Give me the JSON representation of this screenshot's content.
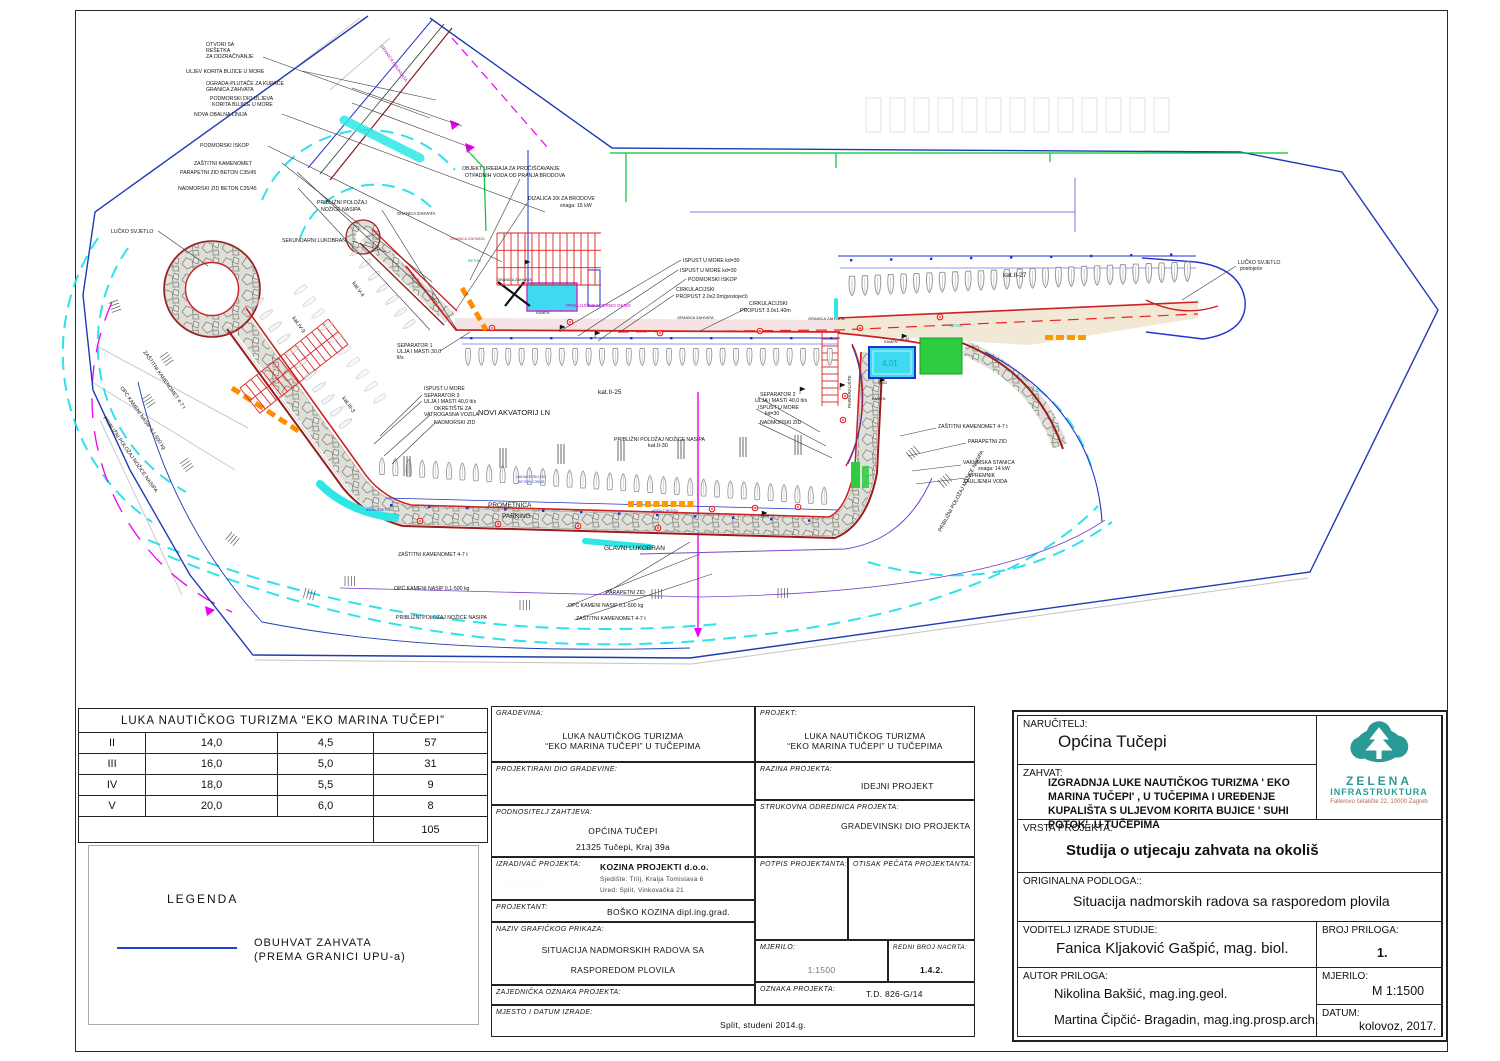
{
  "vessel_table": {
    "title": "LUKA NAUTIČKOG TURIZMA “EKO MARINA TUČEPI”",
    "rows": [
      [
        "II",
        "14,0",
        "4,5",
        "57"
      ],
      [
        "III",
        "16,0",
        "5,0",
        "31"
      ],
      [
        "IV",
        "18,0",
        "5,5",
        "9"
      ],
      [
        "V",
        "20,0",
        "6,0",
        "8"
      ]
    ],
    "total": "105"
  },
  "legend": {
    "title": "LEGENDA",
    "line1": "OBUHVAT ZAHVATA",
    "line2": "(PREMA GRANICI UPU-a)"
  },
  "cad_block": {
    "gradevina_label": "GRADEVINA:",
    "gradevina_1": "LUKA NAUTIČKOG TURIZMA",
    "gradevina_2": "“EKO MARINA TUČEPI” U TUČEPIMA",
    "projektirani_label": "PROJEKTIRANI DIO GRADEVINE:",
    "podnositelj_label": "PODNOSITELJ ZAHTJEVA:",
    "podnositelj_1": "OPĆINA TUČEPI",
    "podnositelj_2": "21325 Tučepi, Kraj 39a",
    "izradivac_label": "IZRADIVAČ PROJEKTA:",
    "izradivac_1": "KOZINA PROJEKTI d.o.o.",
    "izradivac_2": "Sjedište: Trilj, Kralja Tomislava 6",
    "izradivac_3": "Ured: Split, Vinkovačka 21",
    "projektant_label": "PROJEKTANT:",
    "projektant_value": "BOŠKO KOZINA dipl.ing.grad.",
    "naziv_label": "NAZIV GRAFIČKOG PRIKAZA:",
    "naziv_1": "SITUACIJA  NADMORSKIH RADOVA SA",
    "naziv_2": "RASPOREDOM PLOVILA",
    "zajednicka_label": "ZAJEDNIČKA OZNAKA PROJEKTA:",
    "mjesto_label": "MJESTO I DATUM IZRADE:",
    "mjesto_value": "Split, studeni 2014.g.",
    "projekt_label": "PROJEKT:",
    "projekt_1": "LUKA NAUTIČKOG TURIZMA",
    "projekt_2": "“EKO MARINA TUČEPI” U TUČEPIMA",
    "razina_label": "RAZINA PROJEKTA:",
    "razina_value": "IDEJNI PROJEKT",
    "strukovna_label": "STRUKOVNA ODREDNICA PROJEKTA:",
    "strukovna_value": "GRADEVINSKI DIO PROJEKTA",
    "potpis_label": "POTPIS PROJEKTANTA:",
    "otisak_label": "OTISAK PEČATA PROJEKTANTA:",
    "mjerilo_label": "MJERILO:",
    "mjerilo_value": "1:1500",
    "redni_label": "REDNI BROJ NACRTA:",
    "redni_value": "1.4.2.",
    "oznaka_label": "OZNAKA PROJEKTA:",
    "oznaka_value": "T.D. 826-G/14"
  },
  "study_block": {
    "narucitelj_label": "NARUČITELJ:",
    "narucitelj_value": "Općina Tučepi",
    "zahvat_label": "ZAHVAT:",
    "zahvat_value": "IZGRADNJA LUKE NAUTIČKOG TURIZMA ' EKO MARINA TUČEPI' , U TUČEPIMA I UREĐENJE KUPALIŠTA S ULJEVOM KORITA BUJICE ' SUHI POTOK', U TUČEPIMA",
    "vrsta_label": "VRSTA PROJEKTA:",
    "vrsta_value": "Studija o utjecaju zahvata na okoliš",
    "podloga_label": "ORIGINALNA PODLOGA::",
    "podloga_value": "Situacija nadmorskih radova sa rasporedom plovila",
    "voditelj_label": "VODITELJ IZRADE STUDIJE:",
    "voditelj_value": "Fanica Kljaković Gašpić, mag. biol.",
    "broj_label": "BROJ PRILOGA:",
    "broj_value": "1.",
    "autor_label": "AUTOR PRILOGA:",
    "autor_1": "Nikolina Bakšić, mag.ing.geol.",
    "autor_2": "Martina Čipčić- Bragadin, mag.ing.prosp.arch.",
    "mjerilo_label": "MJERILO:",
    "mjerilo_value": "M 1:1500",
    "datum_label": "DATUM:",
    "datum_value": "kolovoz, 2017.",
    "logo_name1": "ZELENA",
    "logo_name2": "INFRASTRUKTURA",
    "logo_address": "Fallerovo šetalište 22, 10000 Zagreb",
    "logo_color": "#2a9a96"
  },
  "drawing": {
    "labels": [
      {
        "t": "OTVORI SA",
        "x": 206,
        "y": 46
      },
      {
        "t": "REŠETKA",
        "x": 206,
        "y": 52
      },
      {
        "t": "ZA ODZRAČIVANJE",
        "x": 206,
        "y": 58
      },
      {
        "t": "ULJEV KORITA BUJICE U MORE",
        "x": 186,
        "y": 73
      },
      {
        "t": "OGRADA-PLUTAČE ZA KUPAČE",
        "x": 206,
        "y": 85
      },
      {
        "t": "GRANICA ZAHVATA",
        "x": 206,
        "y": 91
      },
      {
        "t": "PODMORSKI DIO ULJEVA",
        "x": 210,
        "y": 100
      },
      {
        "t": "KORITA BUJICE U MORE",
        "x": 212,
        "y": 106
      },
      {
        "t": "NOVA OBALNA LINIJA",
        "x": 194,
        "y": 116
      },
      {
        "t": "PODMORSKI ISKOP",
        "x": 200,
        "y": 147
      },
      {
        "t": "ZAŠTITNI KAMENOMET",
        "x": 194,
        "y": 165
      },
      {
        "t": "PARAPETNI ZID BETON C35/45",
        "x": 180,
        "y": 174
      },
      {
        "t": "NADMORSKI ZID BETON C35/45",
        "x": 178,
        "y": 190
      },
      {
        "t": "PRIBLIŽNI POLOŽAJ",
        "x": 317,
        "y": 204
      },
      {
        "t": "NOŽICE NASIPA",
        "x": 321,
        "y": 211
      },
      {
        "t": "LUČKO SVJETLO",
        "x": 111,
        "y": 233
      },
      {
        "t": "SEKUNDARNI LUKOBRAN",
        "x": 282,
        "y": 242
      },
      {
        "t": "GRANICA ZAHVATA",
        "x": 397,
        "y": 215,
        "s": 4.2
      },
      {
        "t": "OBJEKT UREĐAJA ZA PROČIŠĆAVANJE",
        "x": 462,
        "y": 170
      },
      {
        "t": "OTPADNIH VODA OD PRANJA BRODOVA",
        "x": 465,
        "y": 177
      },
      {
        "t": "DIZALICA 20t ZA BRODOVE",
        "x": 528,
        "y": 200
      },
      {
        "t": "snaga: 15 kW",
        "x": 560,
        "y": 207
      },
      {
        "t": "ISPUST U MORE kd=30",
        "x": 683,
        "y": 262
      },
      {
        "t": "ISPUST U MORE kd=30",
        "x": 680,
        "y": 272
      },
      {
        "t": "PODMORSKI ISKOP",
        "x": 688,
        "y": 281
      },
      {
        "t": "CIRKULACIJSKI",
        "x": 676,
        "y": 291
      },
      {
        "t": "PROPUST 2.0x2.0m(postojeći)",
        "x": 676,
        "y": 298
      },
      {
        "t": "CIRKULACIJSKI",
        "x": 749,
        "y": 305
      },
      {
        "t": "PROPUST 3.0x1.40m",
        "x": 740,
        "y": 312
      },
      {
        "t": "GRANICA ZAHVATA",
        "x": 677,
        "y": 319,
        "s": 4
      },
      {
        "t": "GRANICA ZAHVATA",
        "x": 808,
        "y": 320,
        "s": 4
      },
      {
        "t": "PRIKLJUČNO MJERNO OKNO",
        "x": 566,
        "y": 307,
        "s": 4.6,
        "c": "#cc00cc"
      },
      {
        "t": "SEPARATOR 1",
        "x": 397,
        "y": 347
      },
      {
        "t": "ULJA I MASTI 30,0",
        "x": 397,
        "y": 353
      },
      {
        "t": "lt/s",
        "x": 397,
        "y": 359
      },
      {
        "t": "kat.II-25",
        "x": 598,
        "y": 394,
        "s": 6.5
      },
      {
        "t": "ISPUST U MORE",
        "x": 424,
        "y": 390
      },
      {
        "t": "SEPARATOR 3",
        "x": 424,
        "y": 397
      },
      {
        "t": "ULJA I MASTI 40,0 lt/s",
        "x": 424,
        "y": 403
      },
      {
        "t": "OKRETIŠTE ZA",
        "x": 434,
        "y": 410
      },
      {
        "t": "VATROGASNA VOZILA",
        "x": 424,
        "y": 416
      },
      {
        "t": "NOVI AKVATORIJ LN",
        "x": 478,
        "y": 415,
        "s": 7.5
      },
      {
        "t": "NADMORSKI ZID",
        "x": 434,
        "y": 424
      },
      {
        "t": "SEPARATOR 2",
        "x": 760,
        "y": 396
      },
      {
        "t": "ULJA I MASTI 40,0 lt/s",
        "x": 755,
        "y": 402
      },
      {
        "t": "ISPUST U MORE",
        "x": 758,
        "y": 409
      },
      {
        "t": "kd=30",
        "x": 765,
        "y": 415
      },
      {
        "t": "NADMORSKI ZID",
        "x": 760,
        "y": 424
      },
      {
        "t": "PRIBLIŽNI POLOŽAJ NOŽICE NASIPA",
        "x": 614,
        "y": 441
      },
      {
        "t": "kat.II-30",
        "x": 648,
        "y": 447,
        "s": 5.5
      },
      {
        "t": "PROMETNICA",
        "x": 488,
        "y": 507,
        "s": 6.5
      },
      {
        "t": "PARKING",
        "x": 502,
        "y": 518,
        "s": 6.5
      },
      {
        "t": "ZAŠTITNI KAMENOMET 4-7 t",
        "x": 398,
        "y": 556
      },
      {
        "t": "GLAVNI LUKOBRAN",
        "x": 604,
        "y": 550,
        "s": 6.5
      },
      {
        "t": "OPĆ KAMENI NASIP 0,1-500 kg",
        "x": 394,
        "y": 590
      },
      {
        "t": "PARAPETNI ZID",
        "x": 606,
        "y": 594
      },
      {
        "t": "OPĆ KAMENI NASIP 0,1-500 kg",
        "x": 568,
        "y": 607
      },
      {
        "t": "ZAŠTITNI KAMENOMET 4-7 t",
        "x": 576,
        "y": 620
      },
      {
        "t": "PRIBLIŽNI POLOŽAJ NOŽICE NASIPA",
        "x": 396,
        "y": 619
      },
      {
        "t": "kat.II-27",
        "x": 1003,
        "y": 277,
        "s": 6.5
      },
      {
        "t": "LUČKO SVJETLO",
        "x": 1238,
        "y": 264
      },
      {
        "t": "postojeće",
        "x": 1240,
        "y": 270
      },
      {
        "t": "ZAŠTITNI KAMENOMET 4-7 t",
        "x": 938,
        "y": 428
      },
      {
        "t": "PARAPETNI ZID",
        "x": 968,
        "y": 443
      },
      {
        "t": "VAKUMSKA STANICA",
        "x": 963,
        "y": 464
      },
      {
        "t": "snaga: 14 kW",
        "x": 978,
        "y": 470
      },
      {
        "t": "SPREMNIK",
        "x": 968,
        "y": 477
      },
      {
        "t": "ZAULJENIH VODA",
        "x": 963,
        "y": 483
      },
      {
        "t": "ZAŠTITNI KAMENOMET 4-7 t",
        "x": 143,
        "y": 352,
        "r": 55
      },
      {
        "t": "OPĆ KAMENI NASIP 0,1-500 kg",
        "x": 120,
        "y": 388,
        "r": 55
      },
      {
        "t": "PRIBLIŽNI POLOŽAJ NOŽICE NASIPA",
        "x": 103,
        "y": 418,
        "r": 55
      },
      {
        "t": "PRIBLIŽNI POLOŽAJ NOŽICE NASIPA",
        "x": 941,
        "y": 532,
        "r": -62
      },
      {
        "t": "kat.IV-9",
        "x": 292,
        "y": 318,
        "r": 55,
        "s": 5.5
      },
      {
        "t": "kat.III-3",
        "x": 342,
        "y": 398,
        "r": 55,
        "s": 5.5
      },
      {
        "t": "kat.V-4",
        "x": 352,
        "y": 283,
        "r": 55,
        "s": 5.5
      },
      {
        "t": "GRANICA OBUHVATA",
        "x": 380,
        "y": 46,
        "r": 55,
        "s": 4.4,
        "c": "#cc00cc"
      },
      {
        "t": "PARKIRALIŠTE",
        "x": 851,
        "y": 408,
        "r": -90,
        "s": 4.6
      },
      {
        "t": "KAMEN",
        "x": 884,
        "y": 343,
        "s": 3.8
      },
      {
        "t": "KAMEN",
        "x": 872,
        "y": 400,
        "s": 3.8
      },
      {
        "t": "KAMEN",
        "x": 536,
        "y": 314,
        "s": 3.8
      },
      {
        "t": "BETON",
        "x": 950,
        "y": 327,
        "s": 3.8,
        "c": "#00aaaa"
      },
      {
        "t": "BETON",
        "x": 468,
        "y": 262,
        "s": 3.8,
        "c": "#00aaaa"
      },
      {
        "t": "ASFALT BETON",
        "x": 366,
        "y": 511,
        "s": 3.5,
        "c": "#2233cc"
      },
      {
        "t": "ASFALT BETON",
        "x": 652,
        "y": 512,
        "s": 3.5,
        "c": "#2233cc"
      },
      {
        "t": "4.01",
        "x": 882,
        "y": 366,
        "s": 8,
        "c": "#0aa6c4"
      },
      {
        "t": "+1.44",
        "x": 900,
        "y": 340,
        "s": 3.6
      },
      {
        "t": "+1.63",
        "x": 878,
        "y": 384,
        "s": 3.6
      },
      {
        "t": "+1.28",
        "x": 760,
        "y": 517,
        "s": 3.6
      },
      {
        "t": "NADMORSKI ZID",
        "x": 516,
        "y": 478,
        "s": 3.8,
        "c": "#3344cc"
      },
      {
        "t": "BETON C35/45",
        "x": 518,
        "y": 483,
        "s": 3.8,
        "c": "#3344cc"
      },
      {
        "t": "GRANICA ZAHVATA",
        "x": 450,
        "y": 240,
        "s": 3.8,
        "c": "#cc2222"
      },
      {
        "t": "GRANICA ZAHVATA",
        "x": 497,
        "y": 281,
        "s": 3.8
      }
    ],
    "leaders": [
      [
        263,
        57,
        430,
        118
      ],
      [
        302,
        71,
        436,
        100
      ],
      [
        352,
        88,
        462,
        126
      ],
      [
        352,
        103,
        472,
        148
      ],
      [
        282,
        114,
        545,
        212
      ],
      [
        268,
        146,
        502,
        262
      ],
      [
        282,
        163,
        432,
        282
      ],
      [
        297,
        172,
        437,
        302
      ],
      [
        298,
        188,
        430,
        330
      ],
      [
        382,
        210,
        457,
        330
      ],
      [
        158,
        231,
        208,
        266
      ],
      [
        352,
        241,
        386,
        252
      ],
      [
        520,
        179,
        470,
        280
      ],
      [
        527,
        203,
        456,
        310
      ],
      [
        681,
        260,
        562,
        330
      ],
      [
        678,
        270,
        578,
        336
      ],
      [
        686,
        279,
        598,
        341
      ],
      [
        674,
        295,
        620,
        332
      ],
      [
        747,
        308,
        700,
        331
      ],
      [
        440,
        351,
        470,
        332
      ],
      [
        422,
        395,
        380,
        436
      ],
      [
        422,
        401,
        374,
        444
      ],
      [
        430,
        415,
        384,
        456
      ],
      [
        436,
        422,
        392,
        464
      ],
      [
        758,
        397,
        820,
        432
      ],
      [
        756,
        409,
        826,
        446
      ],
      [
        758,
        423,
        832,
        458
      ],
      [
        604,
        594,
        690,
        542
      ],
      [
        566,
        607,
        700,
        554
      ],
      [
        574,
        620,
        712,
        574
      ],
      [
        1236,
        266,
        1182,
        300
      ],
      [
        936,
        428,
        900,
        436
      ],
      [
        966,
        443,
        908,
        456
      ],
      [
        961,
        465,
        912,
        471
      ],
      [
        966,
        478,
        916,
        484
      ]
    ],
    "boat_rows": [
      {
        "x": 468,
        "y": 357,
        "n": 28,
        "dx": 13.4,
        "dy": 0,
        "rot": 180
      },
      {
        "x": 382,
        "y": 466,
        "n": 34,
        "dx": 13.4,
        "dy": 0.9,
        "rot": 0
      },
      {
        "x": 852,
        "y": 286,
        "n": 27,
        "dx": 12.9,
        "dy": -0.55,
        "rot": 180,
        "sc": 1.15
      },
      {
        "x": 258,
        "y": 302,
        "n": 11,
        "dx": 8.8,
        "dy": 12.1,
        "rot": 55,
        "sc": 0.85,
        "op": 0.5
      },
      {
        "x": 300,
        "y": 290,
        "n": 10,
        "dx": 8.8,
        "dy": 12.1,
        "rot": 235,
        "sc": 0.85,
        "op": 0.4
      },
      {
        "x": 356,
        "y": 252,
        "n": 7,
        "dx": 8.8,
        "dy": 12.1,
        "rot": 235,
        "sc": 0.8,
        "op": 0.5
      }
    ],
    "combs": [
      {
        "x": 497,
        "y": 233,
        "w": 104,
        "h": 52,
        "step": 7,
        "bands": 3,
        "rot": 0
      },
      {
        "x": 240,
        "y": 388,
        "w": 112,
        "h": 32,
        "step": 7,
        "bands": 2,
        "rot": -38
      },
      {
        "x": 838,
        "y": 332,
        "w": 74,
        "h": 16,
        "step": 7,
        "bands": 1,
        "rot": 90
      }
    ],
    "orange_rows": [
      {
        "x": 628,
        "y": 501,
        "n": 8,
        "dx": 8.5,
        "w": 6,
        "h": 6
      },
      {
        "x": 1045,
        "y": 335,
        "n": 4,
        "dx": 11,
        "w": 8,
        "h": 5
      }
    ],
    "ticks": [
      [
        168,
        352,
        55
      ],
      [
        150,
        394,
        55
      ],
      [
        188,
        458,
        55
      ],
      [
        232,
        532,
        40
      ],
      [
        306,
        588,
        15
      ],
      [
        345,
        576,
        0
      ],
      [
        652,
        589,
        0
      ],
      [
        778,
        588,
        0
      ],
      [
        906,
        452,
        -40
      ],
      [
        938,
        480,
        -40
      ],
      [
        118,
        300,
        70
      ],
      [
        520,
        600,
        0
      ]
    ],
    "masts": [
      [
        500,
        468
      ],
      [
        558,
        464
      ],
      [
        618,
        461
      ],
      [
        678,
        459
      ],
      [
        740,
        457
      ],
      [
        795,
        455
      ],
      [
        404,
        476
      ]
    ],
    "circles": [
      [
        420,
        521
      ],
      [
        498,
        524
      ],
      [
        578,
        526
      ],
      [
        658,
        528
      ],
      [
        712,
        509
      ],
      [
        755,
        508
      ],
      [
        798,
        507
      ],
      [
        660,
        333
      ],
      [
        760,
        331
      ],
      [
        860,
        328
      ],
      [
        845,
        396
      ],
      [
        843,
        420
      ],
      [
        492,
        328
      ],
      [
        570,
        322
      ],
      [
        940,
        317
      ]
    ],
    "bollard_rows": [
      {
        "x": 470,
        "y": 337,
        "n": 10,
        "dx": 40,
        "dy": 0
      },
      {
        "x": 390,
        "y": 504,
        "n": 12,
        "dx": 38,
        "dy": 1.4
      },
      {
        "x": 850,
        "y": 259,
        "n": 9,
        "dx": 40,
        "dy": -0.7
      }
    ],
    "flags": [
      [
        560,
        332
      ],
      [
        800,
        394
      ],
      [
        902,
        341
      ],
      [
        880,
        385
      ],
      [
        762,
        518
      ],
      [
        525,
        267
      ],
      [
        595,
        338
      ],
      [
        840,
        390
      ]
    ],
    "ghost_row": {
      "x": 866,
      "y": 98,
      "n": 13,
      "dx": 24,
      "w": 15,
      "h": 34
    }
  }
}
